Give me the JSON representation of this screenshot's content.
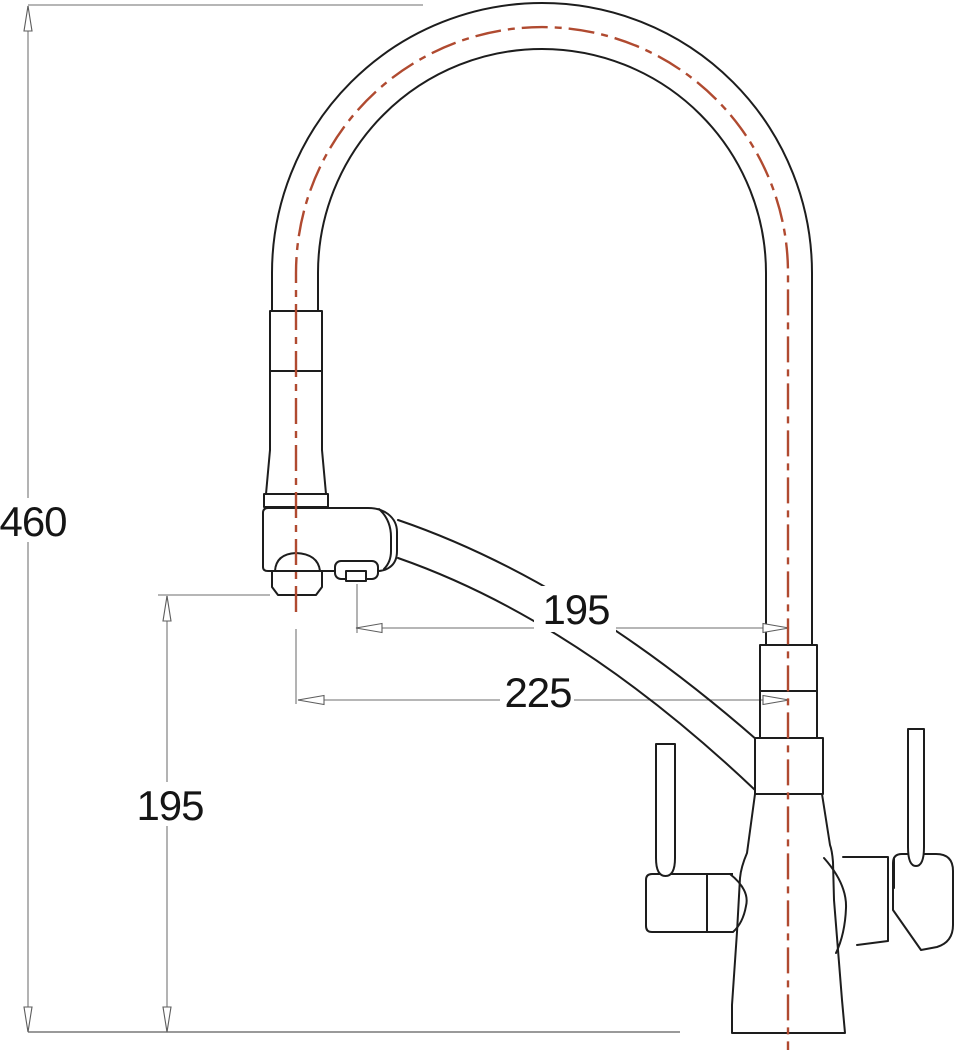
{
  "drawing": {
    "title": "Kitchen faucet technical drawing",
    "view": "front elevation with dimensions",
    "units": "mm",
    "colors": {
      "outline": "#1d1d1d",
      "centerline": "#b04a30",
      "dimension": "#8a8a8a",
      "label": "#151515",
      "background": "#ffffff"
    },
    "labels": {
      "overall_height": "460",
      "outlet_height": "195",
      "aerator_reach": "195",
      "spout_reach": "225"
    }
  }
}
